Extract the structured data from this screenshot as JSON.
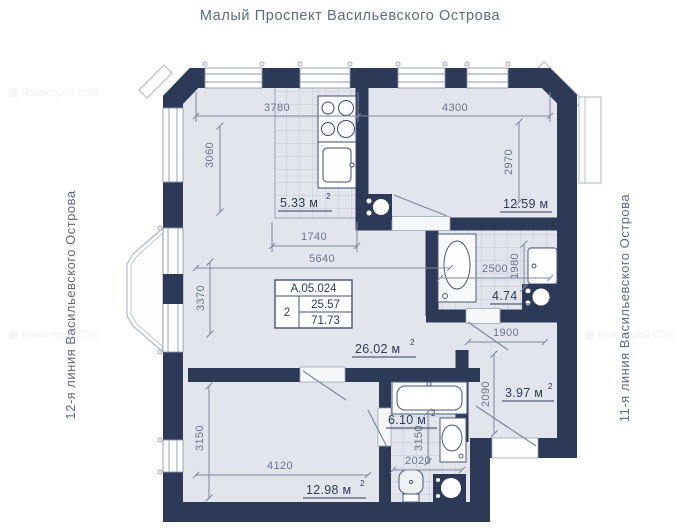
{
  "title": "Малый Проспект Васильевского Острова",
  "streets": {
    "left": "12-я линия Васильевского Острова",
    "right": "11-я линия Васильевского Острова"
  },
  "watermark": "Новострой-СПб",
  "info_box": {
    "unit_id": "А.05.024",
    "rooms_count": "2",
    "living_area": "25.57",
    "total_area": "71.73"
  },
  "rooms": {
    "kitchen": {
      "label": "5.33 м",
      "sup": "2"
    },
    "room_top_right": {
      "label": "12.59 м",
      "sup": ""
    },
    "bathroom": {
      "label": "4.74 м",
      "sup": ""
    },
    "living_room": {
      "label": "26.02 м",
      "sup": "2"
    },
    "hallway": {
      "label": "3.97 м",
      "sup": "2"
    },
    "bathroom_2": {
      "label": "6.10 м",
      "sup": "2"
    },
    "room_bottom_left": {
      "label": "12.98 м",
      "sup": "2"
    }
  },
  "dimensions_mm": {
    "top_left_width": "3780",
    "top_right_width": "4300",
    "top_left_height": "3060",
    "top_right_height": "2970",
    "kitchen_width": "1740",
    "living_width": "5640",
    "living_height": "3370",
    "bathroom_width": "2500",
    "bathroom_height": "1980",
    "hallway_width": "1900",
    "hallway_height": "2090",
    "room_bl_height": "3150",
    "room_bl_width": "4120",
    "bathroom2_height": "3150",
    "bathroom2_width": "2020"
  },
  "colors": {
    "wall": "#2c3a58",
    "floor": "#e3e5ec",
    "dimension": "#68758f",
    "label": "#2e3c5a",
    "title": "#5d6a84"
  }
}
